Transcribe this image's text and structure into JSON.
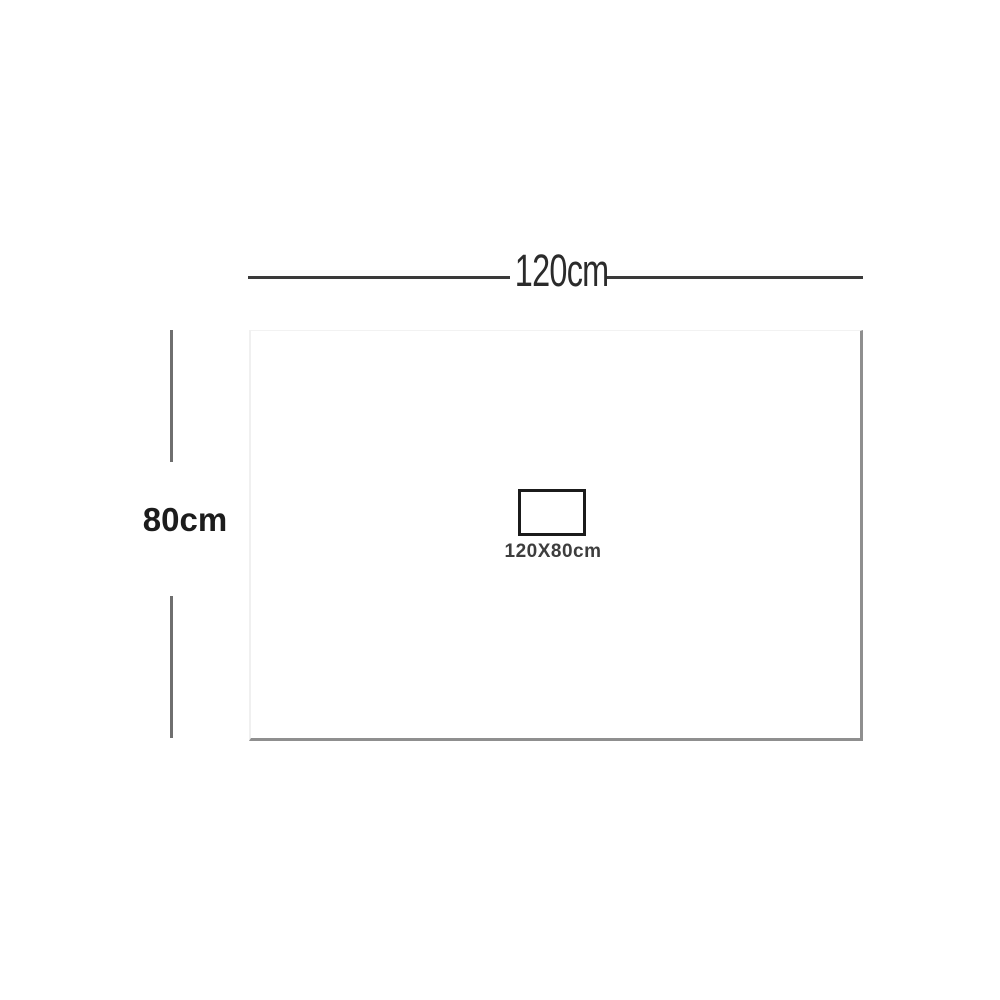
{
  "diagram": {
    "title": "product-dimension-diagram",
    "width_label": "120cm",
    "height_label": "80cm",
    "size_label": "120X80cm",
    "colors": {
      "background": "#ffffff",
      "top_dimension_line": "#3a3a3a",
      "side_dimension_line": "#6f6f6f",
      "panel_fill": "#ffffff",
      "panel_shadow_edge": "#8f8f8f",
      "panel_light_edge": "#f0f0f0",
      "size_rect_border": "#1b1b1b",
      "width_label_color": "#2b2b2b",
      "height_label_color": "#1c1c1c",
      "size_label_color": "#3d3d3d"
    }
  }
}
